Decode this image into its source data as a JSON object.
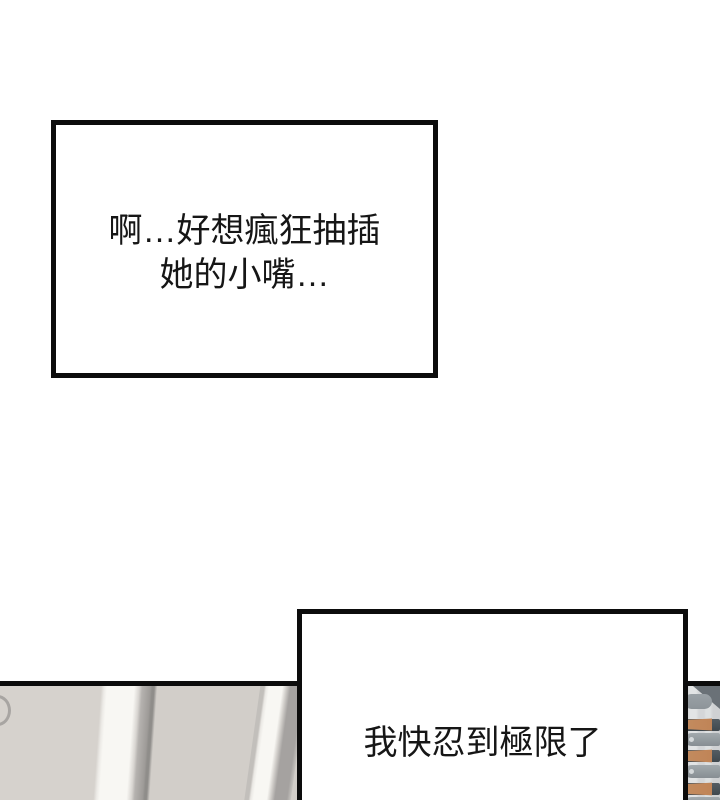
{
  "page": {
    "kind": "webtoon-comic-panel"
  },
  "colors": {
    "page-bg": "#ffffff",
    "box-border": "#0c0c0c",
    "panel-beige": "#d6d2cd",
    "panel-beige-2": "#d2cec9",
    "stripe-white": "#f8f7f3",
    "stripe-gray": "#a5a2a0",
    "knife-bg": "#d4d6d8",
    "knife-dark": "#3f484e",
    "knife-gray": "#a2a9ad",
    "knife-handle": "#c08457"
  },
  "caption_boxes": [
    {
      "lines": [
        "啊…好想瘋狂抽插",
        "她的小嘴…"
      ]
    },
    {
      "lines": [
        "我快忍到極限了"
      ]
    }
  ],
  "artwork": {
    "left": "beige wall panels with slanted light trim stripes and partial round handle arc",
    "right": "knife rack sliver: tan-handled knives and gray knives with tip holes"
  }
}
